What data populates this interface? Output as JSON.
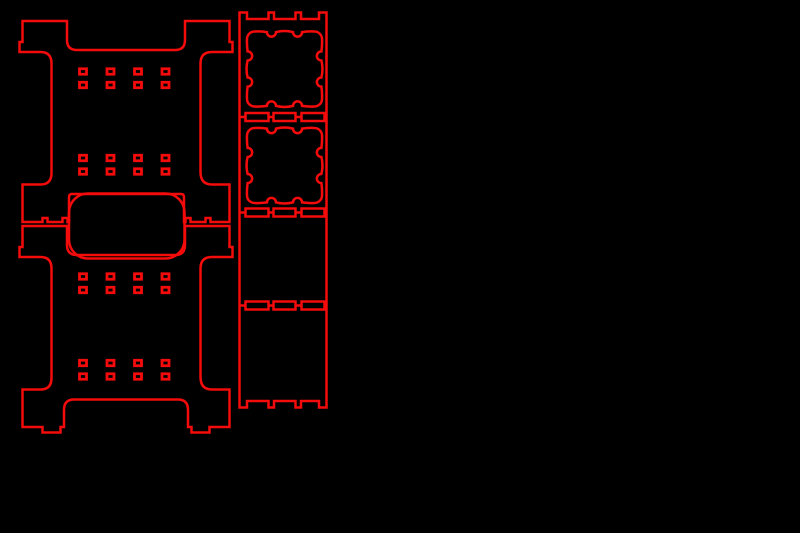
{
  "app": {
    "description": "Laser-cut parts vector layout preview (red cut lines on black background)",
    "canvas": {
      "width": 800,
      "height": 533
    },
    "colors": {
      "background": "#000000",
      "cut_line": "#f40b0b"
    },
    "stroke_width_default": 2.5
  },
  "shapes": {
    "panel_outlines": [
      {
        "name": "side-panel-top-outline",
        "d": "M 22.5,21 H 67 V 40 Q 67,50 77,50 H 175 Q 185,50 185,40 V 21 H 229.5 V 42 H 232.5 V 52 H 212 Q 200.5,52 200.5,63.5 V 172 Q 200.5,184.5 212,184.5 H 229.5 V 222 H 210.5 V 218 H 205.5 V 222 H 190.5 V 218 H 185.5 V 222 H 184 V 197 Q 184,194 181,194 H 72 Q 69,194 69,197 V 222 H 67.5 V 218 H 62.5 V 222 H 47.5 V 218 H 42.5 V 222 H 22.5 V 184.5 H 40.5 Q 51.5,184.5 51.5,173 V 63.5 Q 51.5,52 40.5,52 H 19.5 V 42 H 22.5 Z"
      },
      {
        "name": "side-panel-bottom-outline",
        "d": "M 22.5,226 H 67 V 245 Q 67,255 77,255 H 175 Q 185,255 185,245 V 226 H 229.5 V 247 H 232.5 V 257 H 212 Q 200.5,257 200.5,268.5 V 377 Q 200.5,389.5 212,389.5 H 229.5 V 427 H 209.5 V 432.5 H 191.5 V 427 H 188 V 410 Q 188,399.5 178,399.5 H 74 Q 64,399.5 64,410 V 427 H 60.5 V 432.5 H 42.5 V 427 H 22.5 V 389.5 H 40.5 Q 51.5,389.5 51.5,378 V 268.5 Q 51.5,257 40.5,257 H 19.5 V 247 H 22.5 Z"
      },
      {
        "name": "rail-strip-outline",
        "d": "M 239.5,12.5 H 247 V 19 H 268.5 V 12.5 H 274 V 19 H 295.5 V 12.5 H 301 V 19 H 319 V 12.5 H 326.5 V 407.5 H 319 V 401 H 301 V 407.5 H 295.5 V 401 H 274 V 407.5 H 268.5 V 401 H 247 V 407.5 H 239.5 Z"
      }
    ],
    "rounded_plate": {
      "name": "rounded-plate-outline",
      "x": 69,
      "y": 193.5,
      "w": 115.5,
      "h": 65,
      "rx": 19
    },
    "panel_tab_slots": {
      "name": "panel-tab-slot",
      "col_centers": [
        83,
        110.5,
        138,
        165.5
      ],
      "row_centers": [
        71.5,
        85,
        158,
        171.5,
        276.5,
        290,
        363,
        376.5
      ],
      "w": 7,
      "h": 5.5,
      "stroke_width": 2.8
    },
    "strip_joint_rows": {
      "name": "strip-joint",
      "y_centers": [
        117,
        212.5,
        305.5
      ],
      "slots": [
        {
          "x": 245.5,
          "w": 23
        },
        {
          "x": 273.5,
          "w": 22
        },
        {
          "x": 301.5,
          "w": 23
        }
      ],
      "h": 8,
      "connectors": [
        [
          239.5,
          245.5
        ],
        [
          268.5,
          273.5
        ],
        [
          295.5,
          301.5
        ],
        [
          324.5,
          326.5
        ]
      ]
    },
    "ornate_squares": {
      "name": "ornate-square-cutout",
      "path_d": "M -37.5,-30 A 7.5,7.5 0 0 1 -30,-37.5 Q -24,-37.8 -17.6,-36.9 A 4.55,4.55 0 0 0 -8.5,-36.9 Q 0,-39 8.5,-36.9 A 4.55,4.55 0 0 0 17.6,-36.9 Q 24,-37.8 30,-37.5 A 7.5,7.5 0 0 1 37.5,-30 Q 37.8,-24 36.9,-17.6 A 4.55,4.55 0 0 0 36.9,-8.5 Q 39,0 36.9,8.5 A 4.55,4.55 0 0 0 36.9,17.6 Q 37.8,24 37.5,30 A 7.5,7.5 0 0 1 30,37.5 Q 24,37.8 17.6,36.9 A 4.55,4.55 0 0 0 8.5,36.9 Q 0,39 -8.5,36.9 A 4.55,4.55 0 0 0 -17.6,36.9 Q -24,37.8 -30,37.5 A 7.5,7.5 0 0 1 -37.5,30 Q -37.8,24 -36.9,17.6 A 4.55,4.55 0 0 0 -36.9,8.5 Q -39,0 -36.9,-8.5 A 4.55,4.55 0 0 0 -36.9,-17.6 Q -37.8,-24 -37.5,-30 Z",
      "instances": [
        {
          "cx": 284.5,
          "cy": 69
        },
        {
          "cx": 284.5,
          "cy": 165.5
        }
      ]
    }
  }
}
